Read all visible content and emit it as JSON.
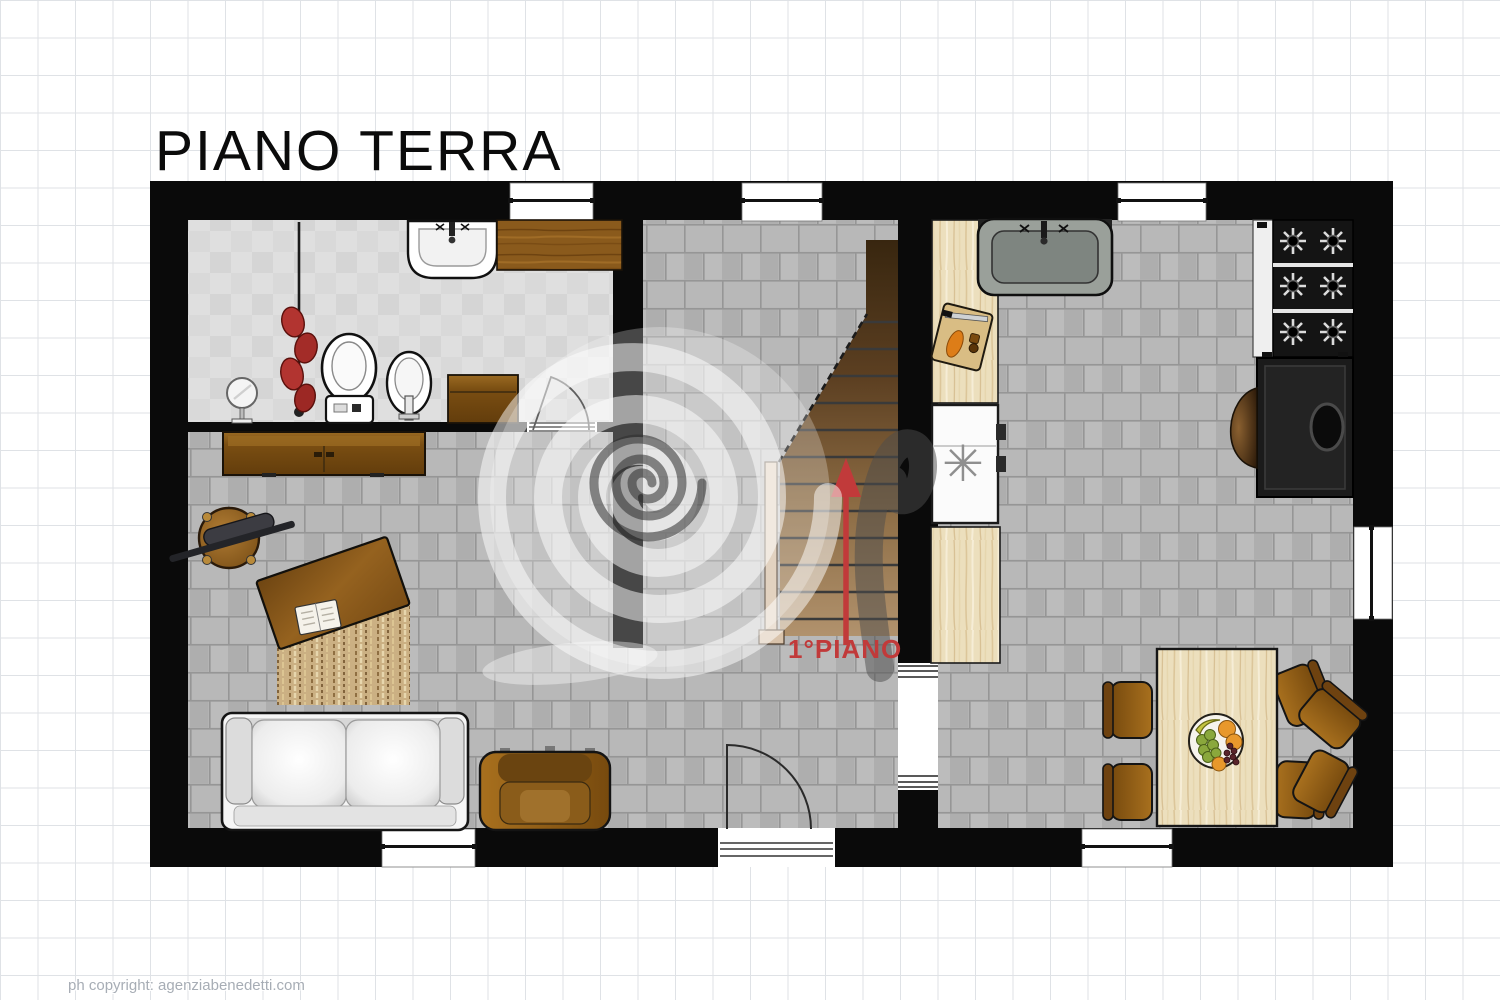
{
  "title": "PIANO TERRA",
  "stair_label": {
    "text": "1°PIANO",
    "color": "#c13a3a"
  },
  "footer": {
    "copyright": "ph copyright: agenziabenedetti.com"
  },
  "symbols": {
    "freezer_defrost": "✳"
  },
  "colors": {
    "walls": "#0a0a0a",
    "floor_brick": "#b4b4b4",
    "bathroom_tile": "#dfdfdf",
    "wood_dark": "#8a5a1c",
    "wood_light": "#ecdfbd",
    "arrow_red": "#c13a3a",
    "grid_line": "#dfe2e6"
  }
}
